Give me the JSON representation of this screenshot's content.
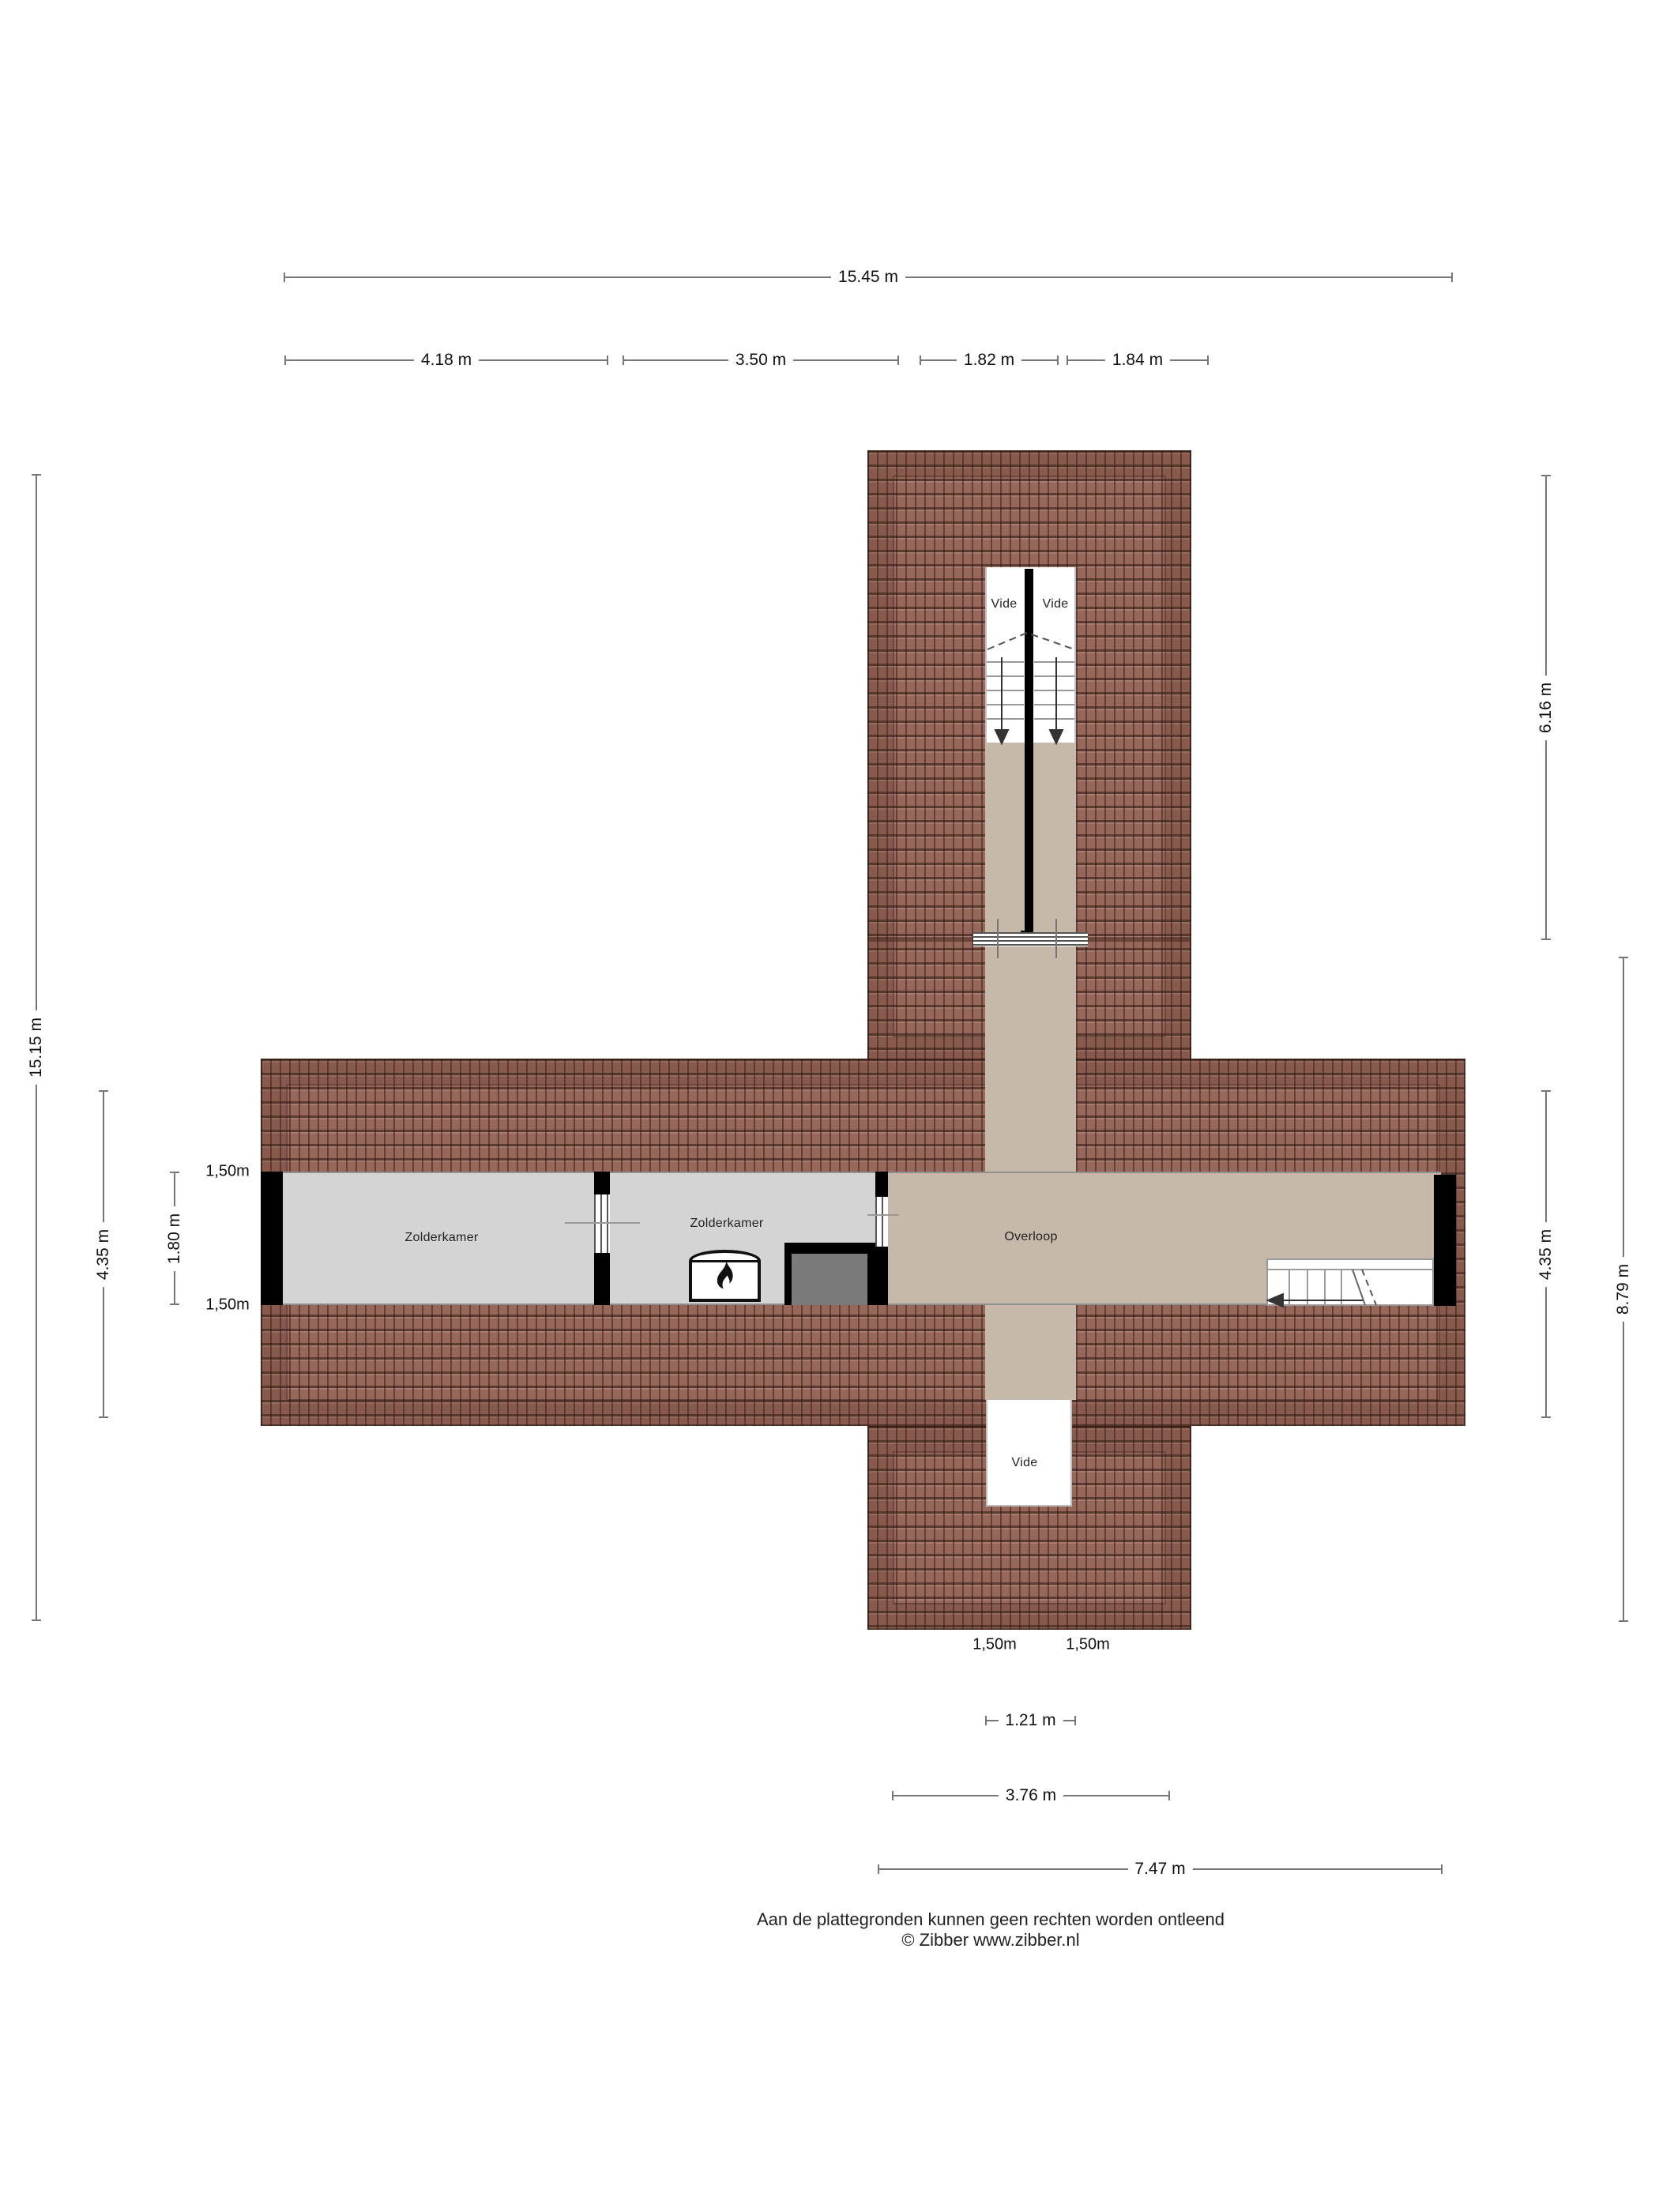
{
  "meta": {
    "drawing_type": "floor-plan",
    "floor": "attic"
  },
  "colors": {
    "roof_tile": "#96675a",
    "roof_seam": "#3a231c",
    "floor_gray": "#d4d4d4",
    "floor_tan": "#c7b9a9",
    "wall": "#000000",
    "closet_fill": "#7a7a7a",
    "dimension_line": "#767676"
  },
  "rooms": {
    "zolderkamer_left": {
      "label": "Zolderkamer"
    },
    "zolderkamer_right": {
      "label": "Zolderkamer"
    },
    "overloop": {
      "label": "Overloop"
    },
    "vide_top_left": {
      "label": "Vide"
    },
    "vide_top_right": {
      "label": "Vide"
    },
    "vide_bottom": {
      "label": "Vide"
    }
  },
  "dimensions": {
    "top_total": {
      "label": "15.45 m"
    },
    "top_1": {
      "label": "4.18 m"
    },
    "top_2": {
      "label": "3.50 m"
    },
    "top_3": {
      "label": "1.82 m"
    },
    "top_4": {
      "label": "1.84 m"
    },
    "left_total": {
      "label": "15.15 m"
    },
    "left_mid": {
      "label": "4.35 m"
    },
    "left_inner": {
      "label": "1.80 m"
    },
    "left_150_top": {
      "label": "1,50m"
    },
    "left_150_bottom": {
      "label": "1,50m"
    },
    "right_top": {
      "label": "6.16 m"
    },
    "right_mid": {
      "label": "4.35 m"
    },
    "right_total": {
      "label": "8.79 m"
    },
    "bottom_150_left": {
      "label": "1,50m"
    },
    "bottom_150_right": {
      "label": "1,50m"
    },
    "bottom_vide": {
      "label": "1.21 m"
    },
    "bottom_wing": {
      "label": "3.76 m"
    },
    "bottom_total": {
      "label": "7.47 m"
    }
  },
  "footer": {
    "line1": "Aan de plattegronden kunnen geen rechten worden ontleend",
    "line2": "© Zibber www.zibber.nl"
  }
}
